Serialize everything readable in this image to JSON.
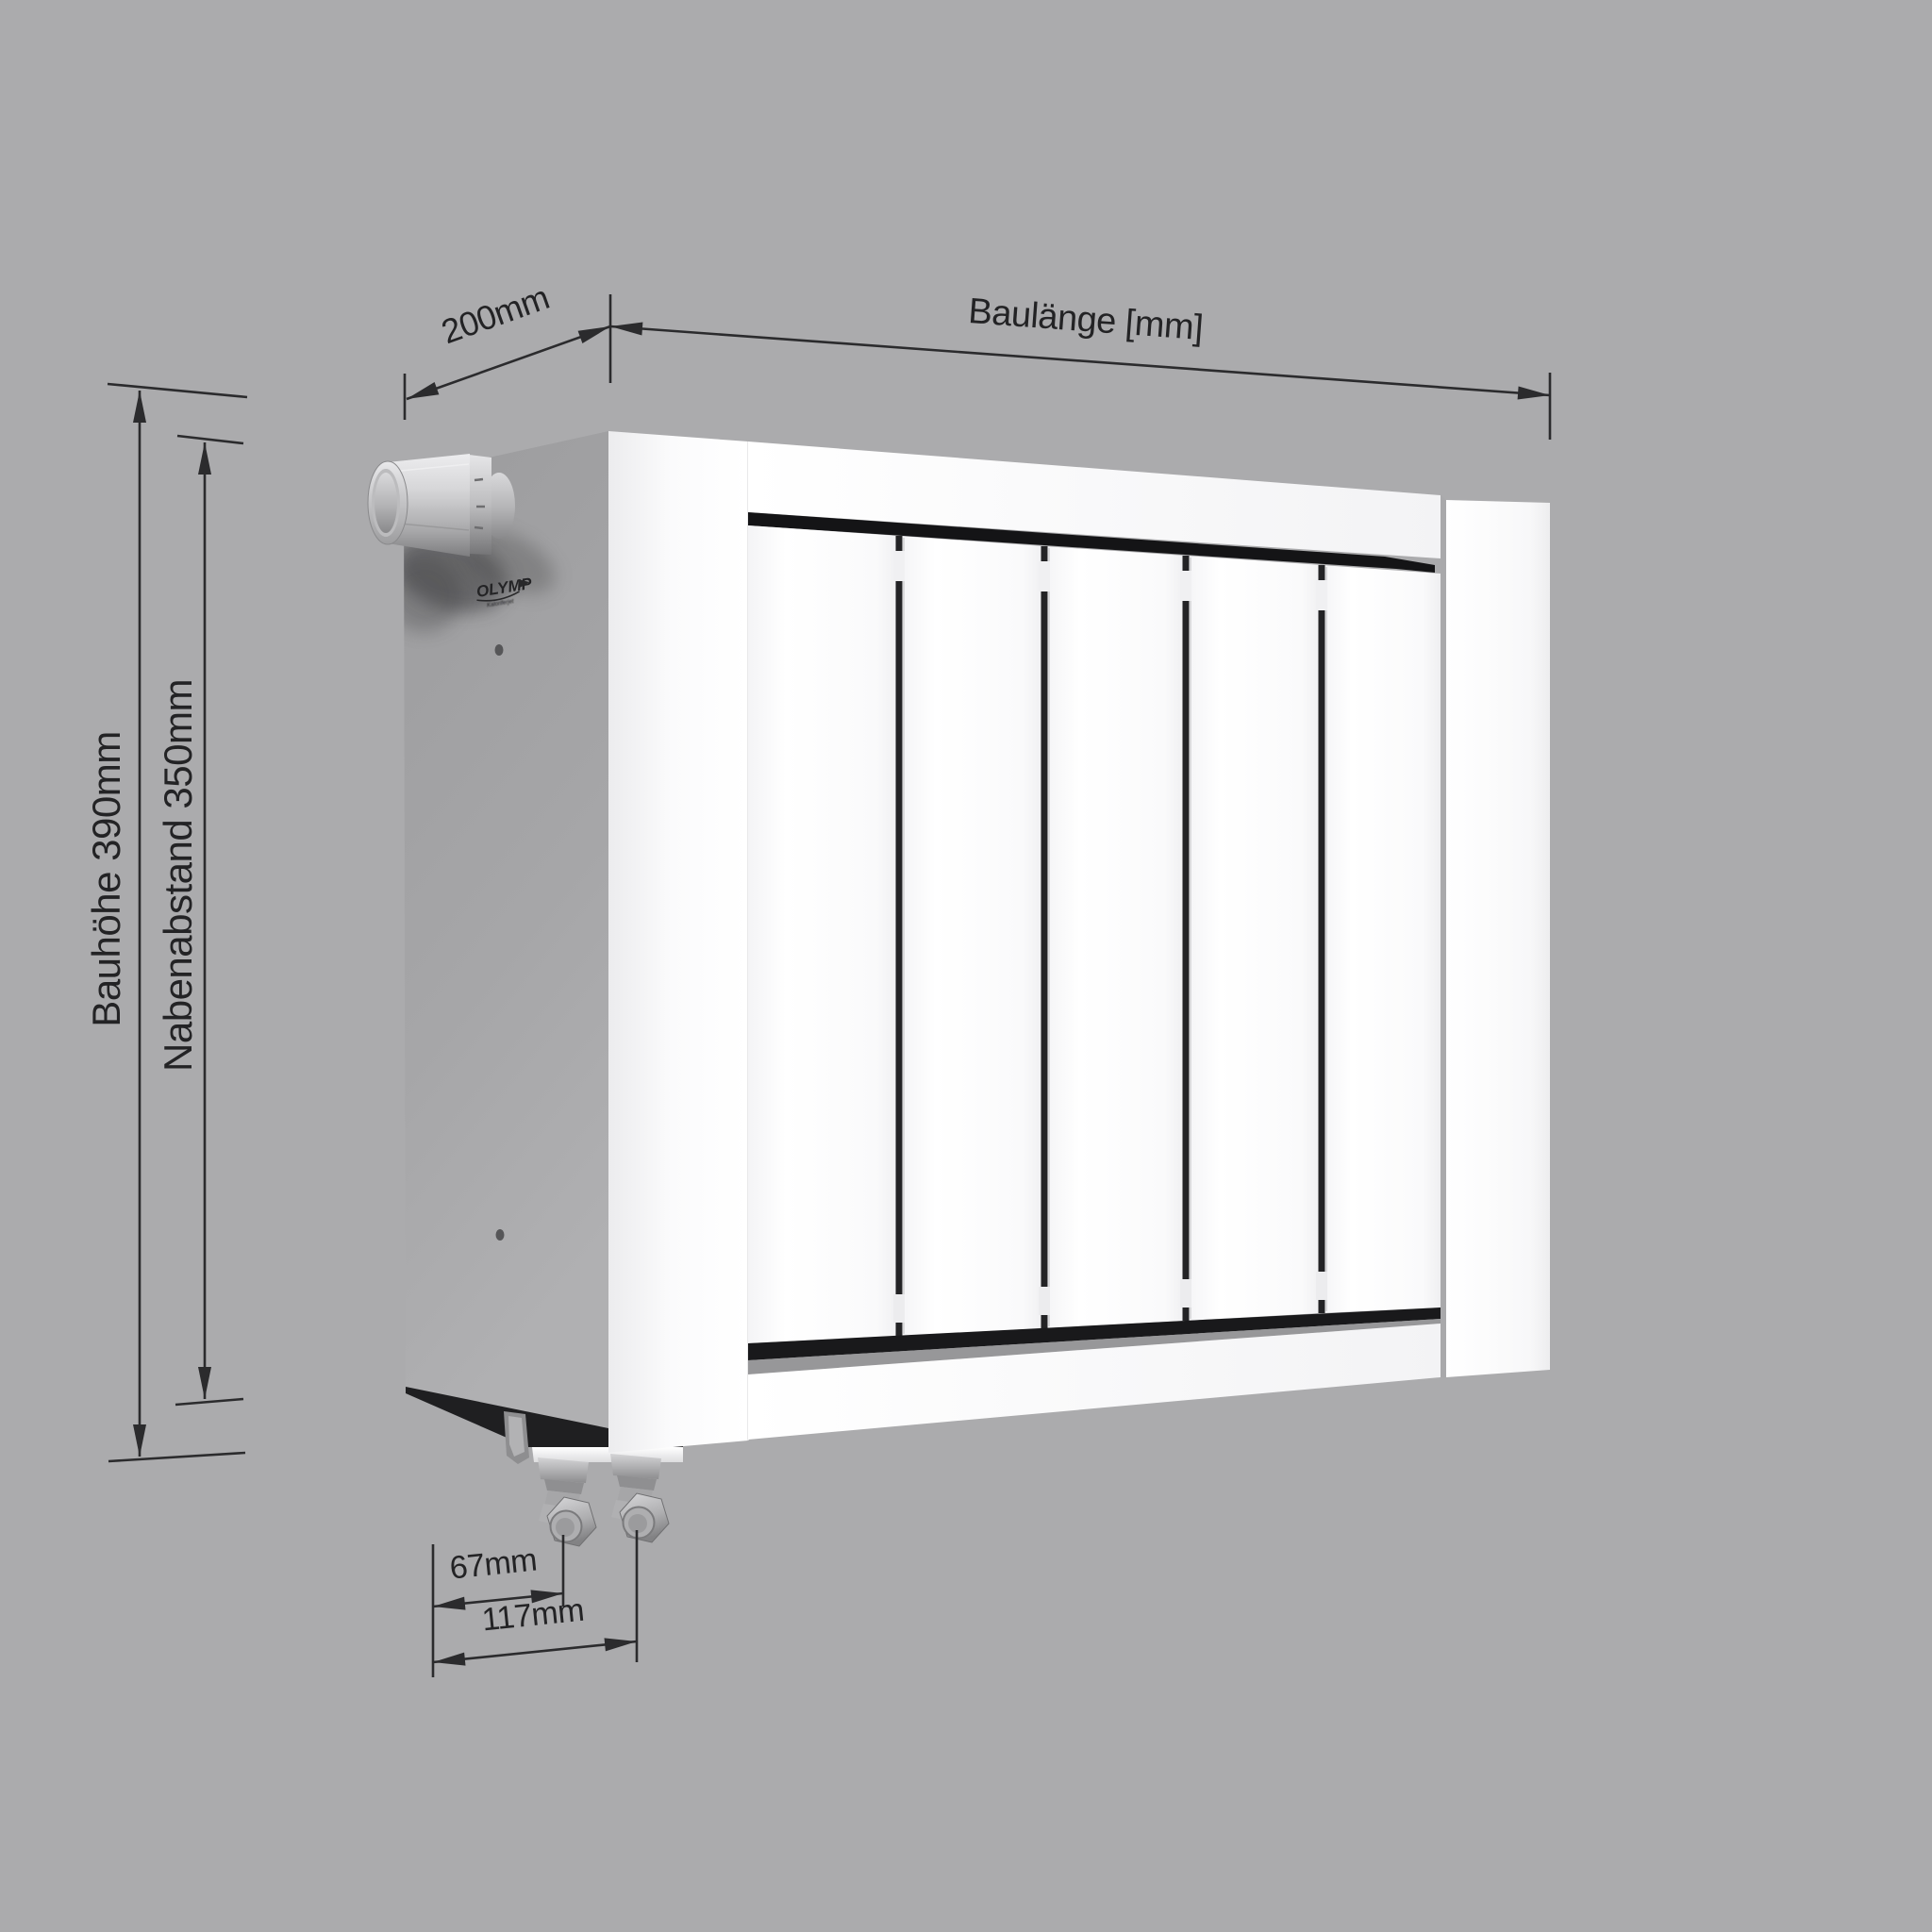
{
  "scene": {
    "type": "technical-dimension-drawing",
    "background_color": "#ababad",
    "line_color": "#2b2b2d",
    "text_color": "#232325"
  },
  "product": {
    "kind": "radiator",
    "brand": "OLYMP",
    "brand_tagline": "Kaloriferjet",
    "front_color": "#fbfbfc",
    "side_color": "#a3a3a5",
    "slot_color": "#161618"
  },
  "dimensions": {
    "depth": {
      "label": "200mm"
    },
    "length": {
      "label": "Baulänge [mm]"
    },
    "height": {
      "label": "Bauhöhe 390mm"
    },
    "hub_distance": {
      "label": "Nabenabstand 350mm"
    },
    "valve_offset": {
      "label": "67mm"
    },
    "valve_pitch": {
      "label": "117mm"
    }
  }
}
